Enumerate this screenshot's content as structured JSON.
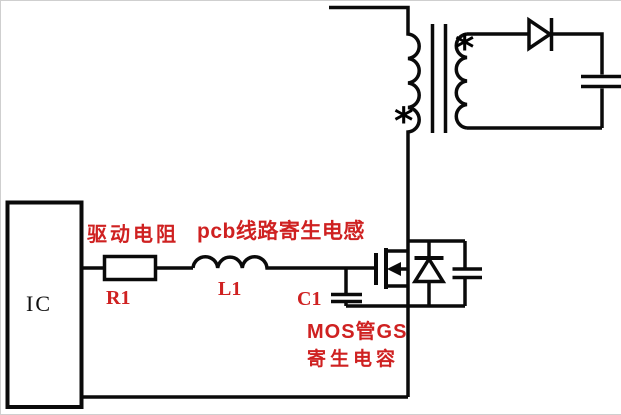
{
  "canvas": {
    "width": 621,
    "height": 413,
    "background": "#ffffff"
  },
  "colors": {
    "wire": "#0a0a0a",
    "label_red": "#cf2121",
    "ic_text": "#111111"
  },
  "ic": {
    "label": "IC"
  },
  "components": {
    "resistor_r1": {
      "designator": "R1",
      "description": "驱动电阻"
    },
    "inductor_l1": {
      "designator": "L1",
      "description": "pcb线路寄生电感"
    },
    "capacitor_c1": {
      "designator": "C1",
      "description_line1": "MOS管GS",
      "description_line2": "寄生电容"
    },
    "transformer": {
      "primary_polarity_mark": "*",
      "secondary_polarity_mark": "*"
    }
  }
}
